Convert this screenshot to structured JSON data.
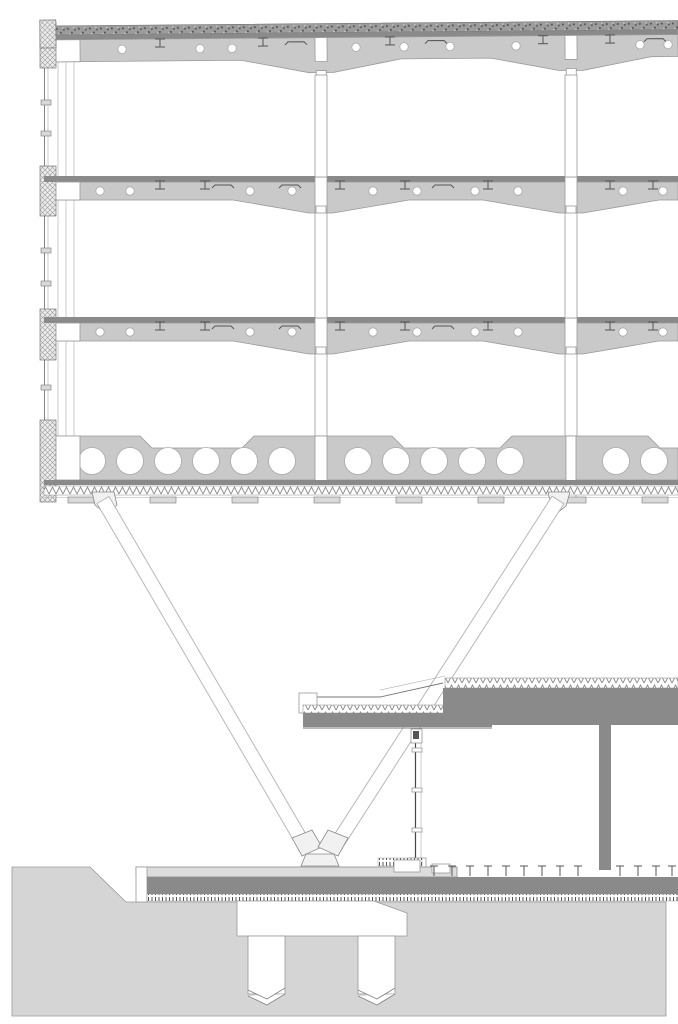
{
  "title": "building-section-technical-drawing",
  "colors": {
    "background": "#ffffff",
    "beam": "#c9c9c9",
    "slab_dark": "#8a8a8a",
    "outline": "#999999",
    "outline_dark": "#666666",
    "terrain": "#d5d5d5",
    "plaza": "#dcdcdc",
    "white": "#ffffff",
    "strut_stroke": "#b8b8b8",
    "gravel": "#9c9c9c",
    "hatch_bg": "#ececec",
    "glyph": "#555555"
  },
  "drawing": {
    "parts": [
      "roof-build-up-with-gravel-and-insulation",
      "castellated-floor-beams-with-web-openings",
      "steel-columns",
      "hollow-core-bottom-slab",
      "left-curtain-wall-facade",
      "v-shaped-raking-struts",
      "single-storey-podium-with-canopy",
      "glazed-podium-facade",
      "ground-terrain-with-pile-cap-and-piles"
    ],
    "levels": [
      {
        "container": "roof-glyphs",
        "cy": 50,
        "circle_r": 4.2,
        "circles": [
          122,
          200,
          232,
          356,
          404,
          450,
          516,
          640,
          668
        ],
        "ibeams": [
          160,
          263,
          390,
          543,
          610
        ],
        "brackets": [
          296,
          436,
          655
        ]
      },
      {
        "container": "l2-glyphs",
        "cy": 191,
        "circle_r": 4.2,
        "circles": [
          100,
          130,
          250,
          292,
          373,
          417,
          475,
          518,
          623,
          663
        ],
        "ibeams": [
          160,
          205,
          340,
          405,
          488,
          610,
          653
        ],
        "brackets": [
          223,
          290,
          443
        ]
      },
      {
        "container": "l3-glyphs",
        "cy": 332,
        "circle_r": 4.2,
        "circles": [
          100,
          130,
          250,
          292,
          373,
          417,
          475,
          518,
          623,
          663
        ],
        "ibeams": [
          160,
          205,
          340,
          405,
          488,
          610,
          653
        ],
        "brackets": [
          223,
          290,
          443
        ]
      },
      {
        "container": "slab-circles",
        "cy": 461,
        "circle_r": 13.5,
        "circles": [
          92,
          130,
          168,
          206,
          244,
          282,
          358,
          396,
          434,
          472,
          510,
          616,
          654
        ]
      }
    ],
    "soffit_boxes_x": [
      68,
      150,
      232,
      314,
      396,
      478,
      560,
      642
    ],
    "pedestals_x": [
      434,
      452,
      470,
      488,
      506,
      524,
      542,
      560,
      578,
      620,
      638,
      656,
      672
    ],
    "transoms_y": [
      748,
      788,
      828
    ],
    "facade": {
      "blocks": [
        [
          22,
          46
        ],
        [
          166,
          50
        ],
        [
          309,
          51
        ],
        [
          420,
          82
        ]
      ],
      "ticks_y": [
        100,
        131,
        248,
        281,
        385
      ]
    }
  }
}
